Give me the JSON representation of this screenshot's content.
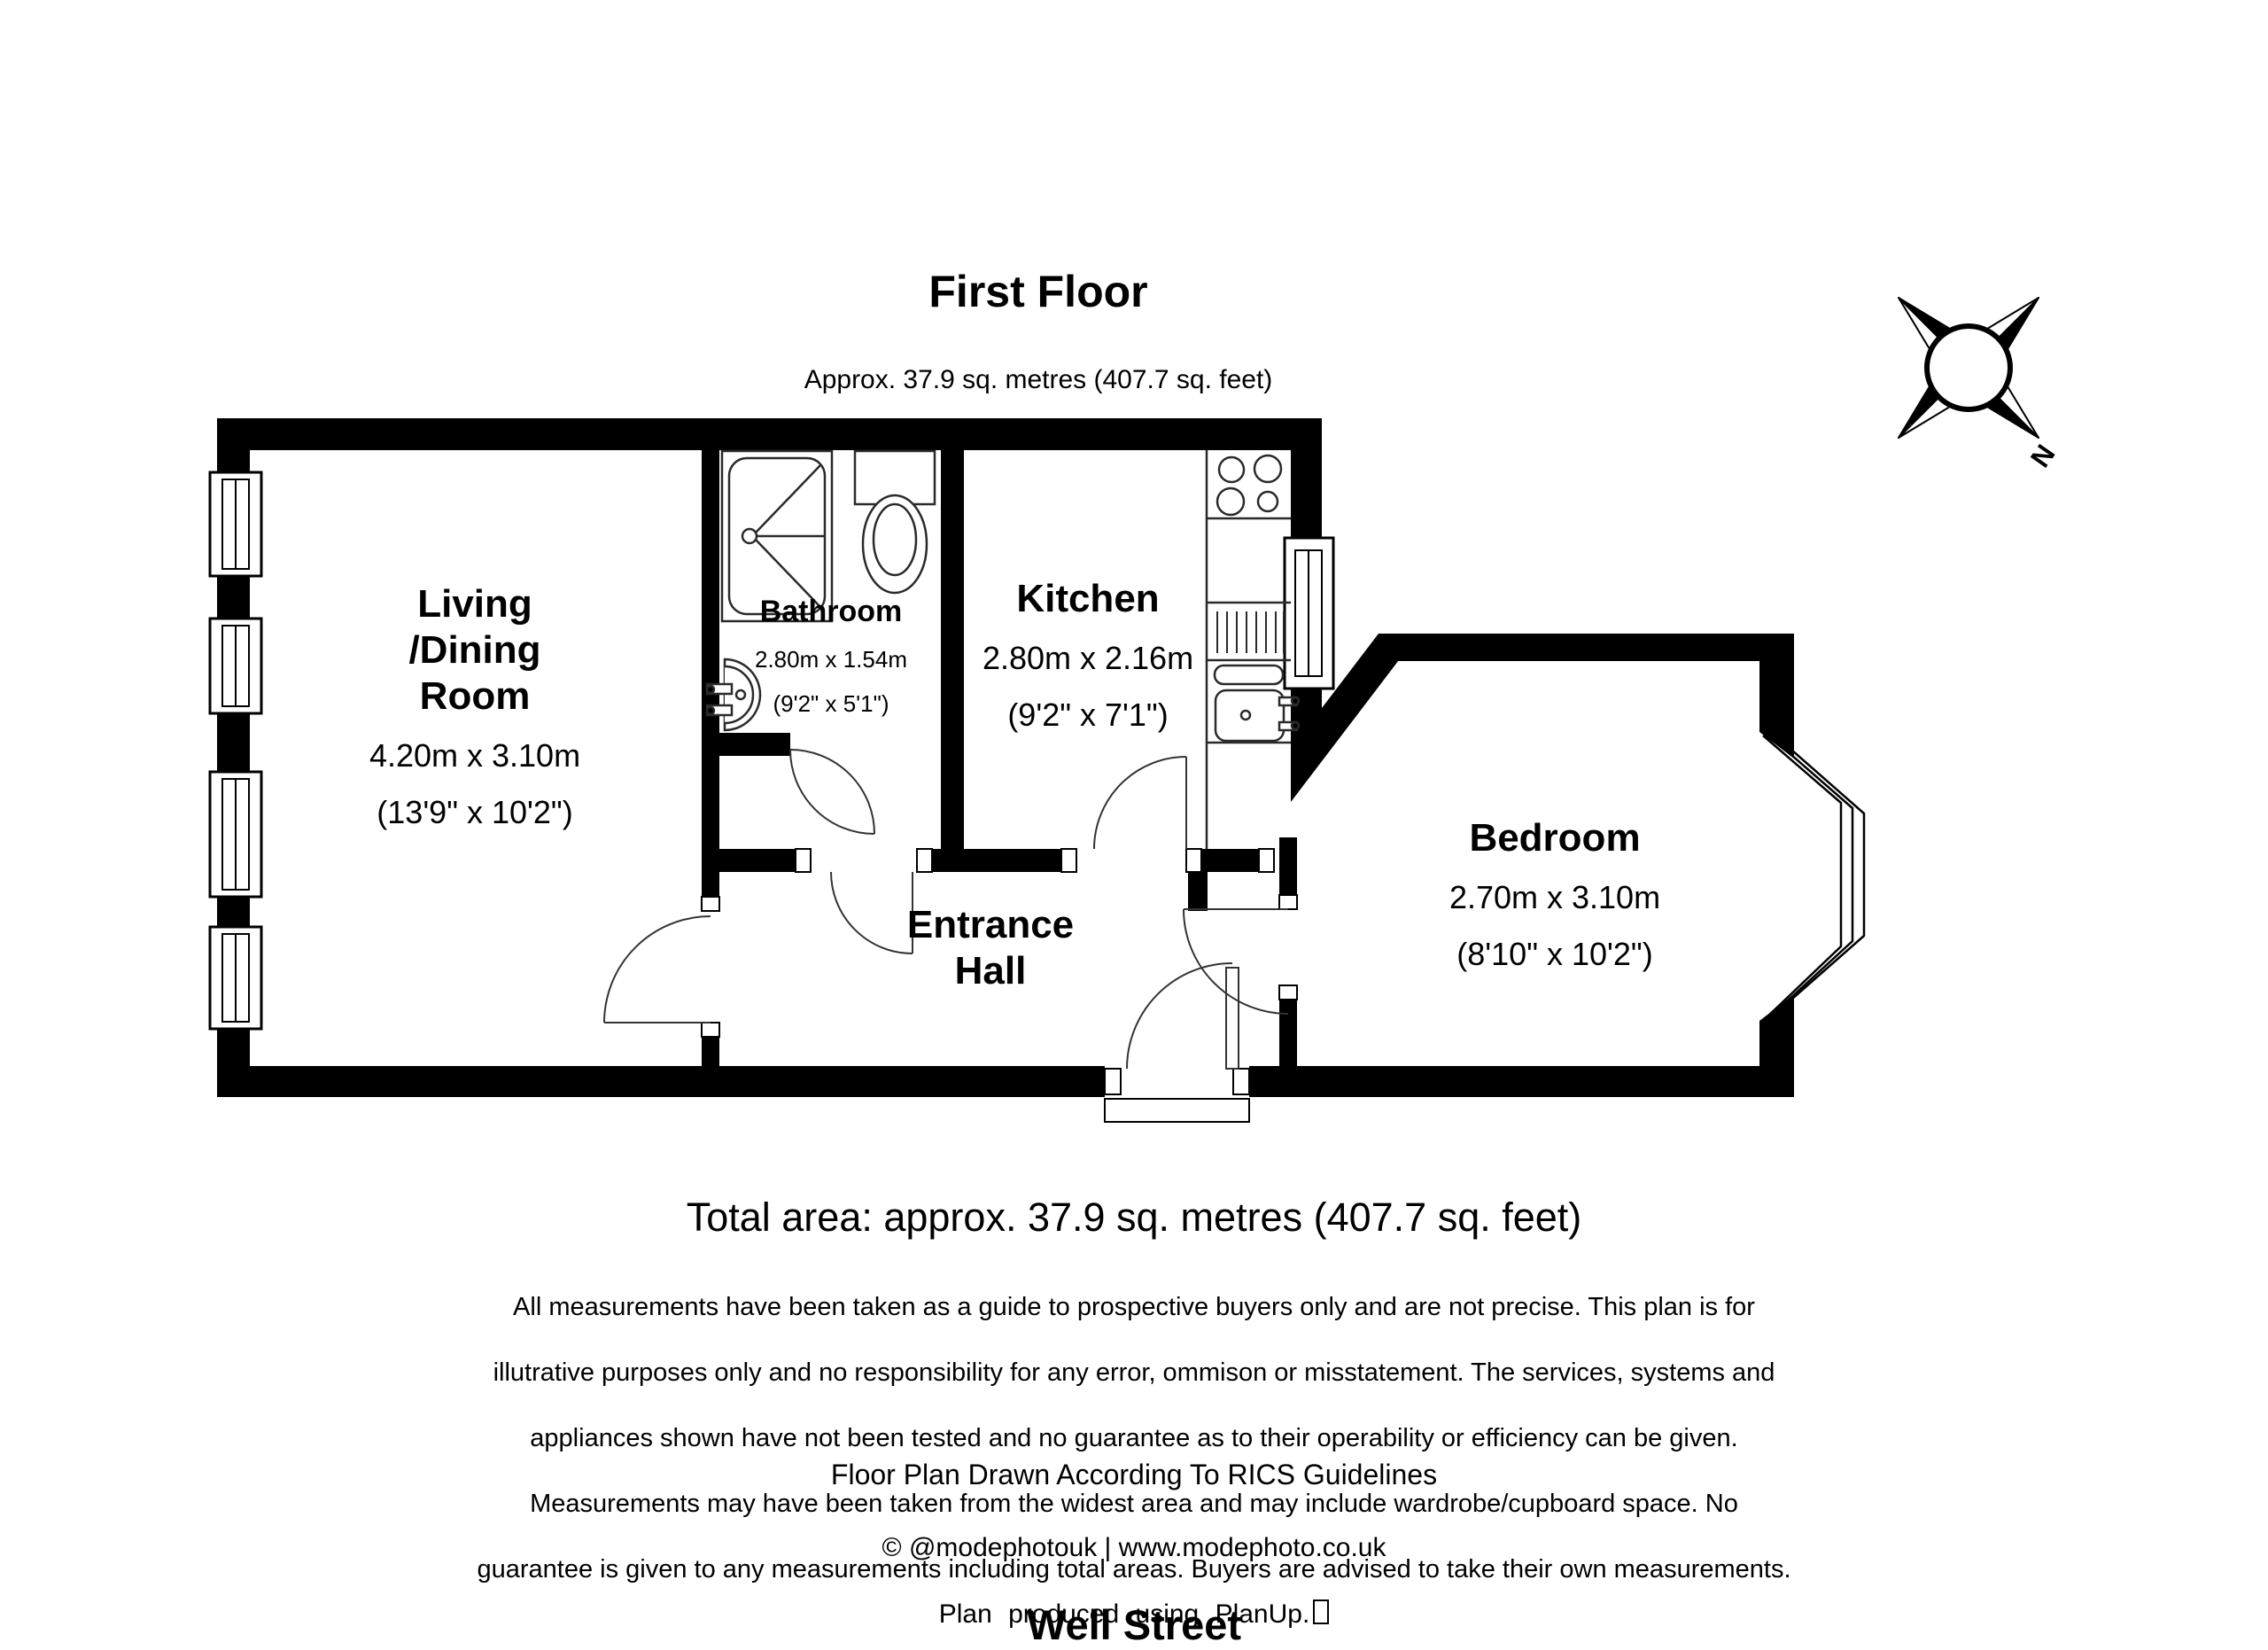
{
  "header": {
    "title": "First Floor",
    "subtitle": "Approx. 37.9 sq. metres (407.7 sq. feet)"
  },
  "rooms": {
    "living": {
      "name": "Living\n/Dining\nRoom",
      "dims_m": "4.20m x 3.10m",
      "dims_ft": "(13'9\" x 10'2\")"
    },
    "bathroom": {
      "name": "Bathroom",
      "dims_m": "2.80m x 1.54m",
      "dims_ft": "(9'2\" x 5'1\")"
    },
    "kitchen": {
      "name": "Kitchen",
      "dims_m": "2.80m x 2.16m",
      "dims_ft": "(9'2\" x 7'1\")"
    },
    "hall": {
      "name": "Entrance\nHall"
    },
    "bedroom": {
      "name": "Bedroom",
      "dims_m": "2.70m x 3.10m",
      "dims_ft": "(8'10\" x 10'2\")"
    }
  },
  "compass": {
    "north_label": "N"
  },
  "footer": {
    "total_area": "Total area: approx. 37.9 sq. metres (407.7 sq. feet)",
    "disclaimer_lines": [
      "All measurements have been taken as a guide to prospective buyers only and are not precise. This plan is for",
      "illutrative purposes only and no responsibility for any error, ommison or misstatement. The services, systems and",
      "appliances shown have not been tested and no guarantee as to their operability or efficiency can be given.",
      "Measurements may have been taken from the widest area and may include wardrobe/cupboard space. No",
      "guarantee is given to any measurements including total areas. Buyers are advised to take their own measurements."
    ],
    "rics": "Floor Plan Drawn According To RICS Guidelines",
    "credit": "© @modephotouk | www.modephoto.co.uk",
    "produced": "Plan produced using PlanUp.",
    "address": "Well Street"
  },
  "colors": {
    "wall": "#000000",
    "background": "#ffffff",
    "line": "#2a2a2a"
  }
}
